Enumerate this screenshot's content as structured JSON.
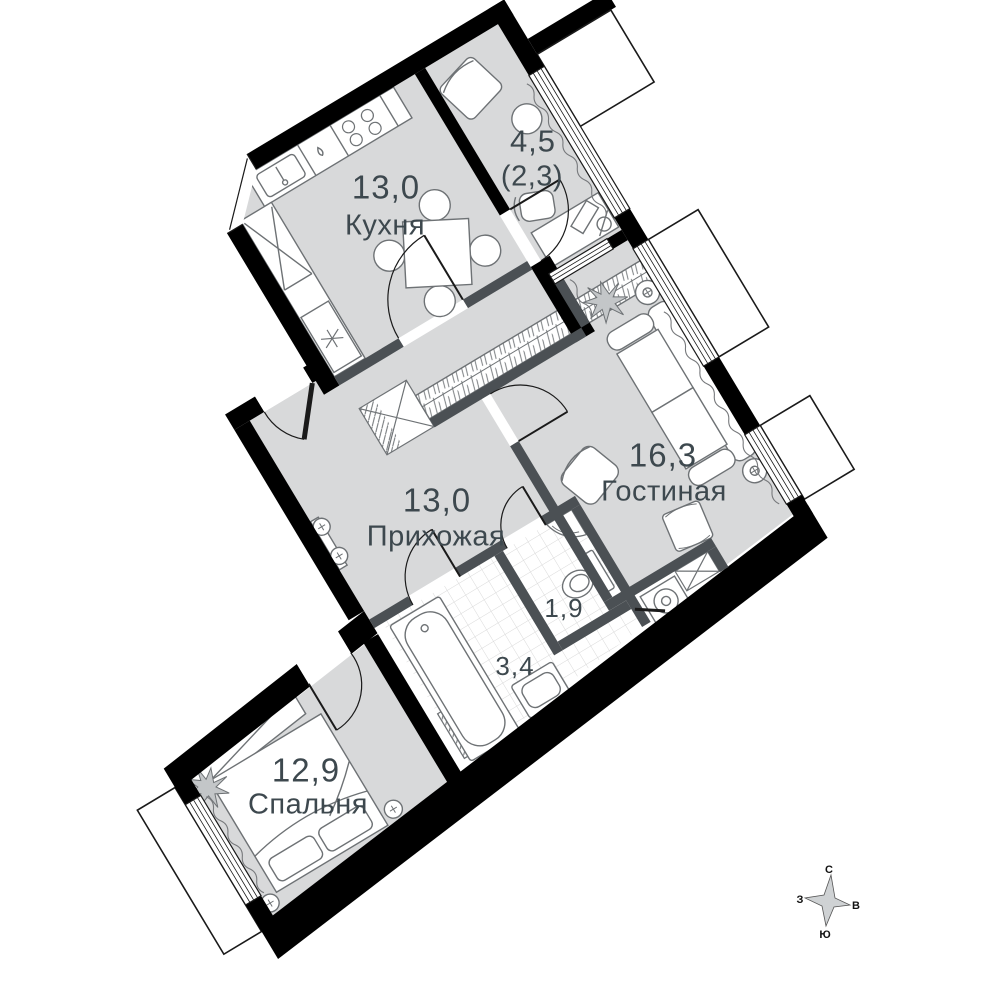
{
  "plan": {
    "rooms": {
      "kitchen": {
        "area": "13,0",
        "name": "Кухня"
      },
      "loggia": {
        "area": "4,5",
        "area_reduced": "(2,3)"
      },
      "living": {
        "area": "16,3",
        "name": "Гостиная"
      },
      "hall": {
        "area": "13,0",
        "name": "Прихожая"
      },
      "wc": {
        "area": "1,9"
      },
      "bathroom": {
        "area": "3,4"
      },
      "bedroom": {
        "area": "12,9",
        "name": "Спальня"
      }
    },
    "compass": {
      "north": "С",
      "south": "Ю",
      "west": "З",
      "east": "В"
    },
    "colors": {
      "floor": "#d8d9da",
      "outer_wall": "#000000",
      "partition": "#4b5054",
      "furniture_stroke": "#6e7275",
      "label_text": "#3d484e"
    }
  }
}
